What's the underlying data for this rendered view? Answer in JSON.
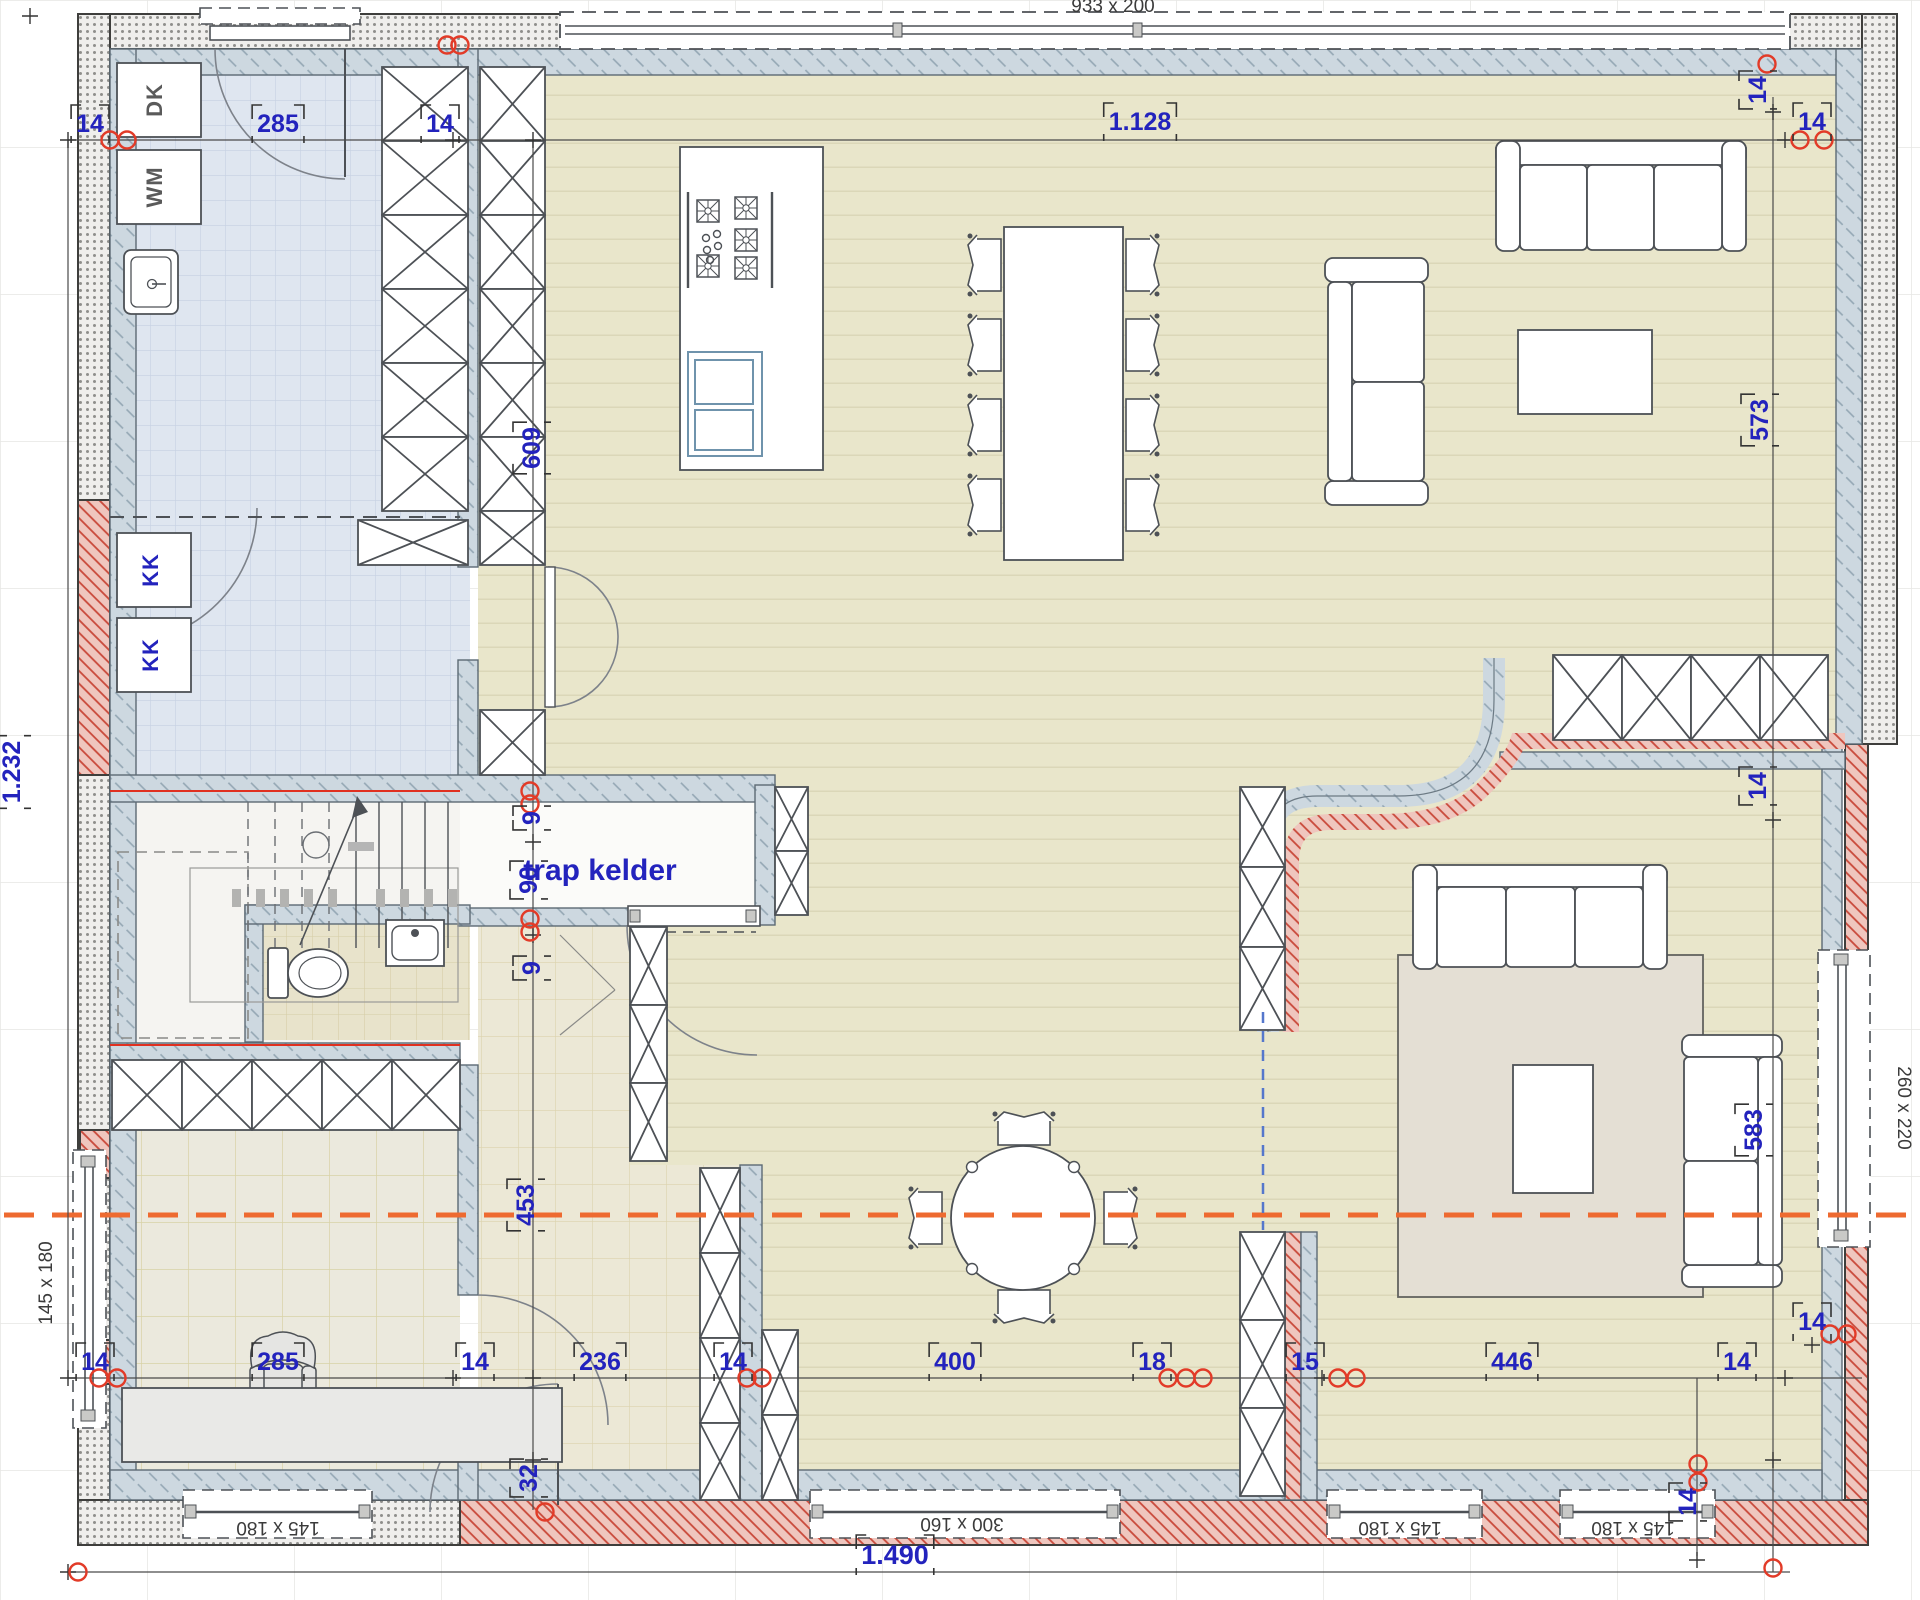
{
  "plan": {
    "room_label": "trap kelder",
    "appliances": {
      "dk": "DK",
      "wm": "WM",
      "kk_upper": "KK",
      "kk_lower": "KK"
    },
    "window_sizes": {
      "top": "933 x 200",
      "left": "145 x 180",
      "right": "260 x 220",
      "bottom_left": "145 x 180",
      "bottom_center": "300 x 160",
      "bottom_mid_right": "145 x 180",
      "bottom_far_right": "145 x 180"
    },
    "dims": {
      "top_14_left": "14",
      "top_285": "285",
      "top_14_mid": "14",
      "top_1128": "1.128",
      "top_14_right": "14",
      "left_1232": "1.232",
      "mid_609": "609",
      "mid_9_upper": "9",
      "mid_90": "90",
      "mid_9_lower": "9",
      "mid_453": "453",
      "mid_32": "32",
      "right_14_top": "14",
      "right_573": "573",
      "right_14_wall": "14",
      "right_583": "583",
      "right_14_lower": "14",
      "right_14_corner": "14",
      "bottom_14_a": "14",
      "bottom_285": "285",
      "bottom_14_b": "14",
      "bottom_236": "236",
      "bottom_14_c": "14",
      "bottom_400": "400",
      "bottom_18": "18",
      "bottom_15": "15",
      "bottom_446": "446",
      "bottom_14_d": "14",
      "total_1490": "1.490"
    },
    "colors": {
      "dim_blue": "#2323bd",
      "marker_red": "#e23b28",
      "axis_orange": "#ee6a30",
      "wall_red_hatch": "#efc6be",
      "wall_blue_hatch": "#cdd8e0",
      "floor_wood": "#e9e6cb",
      "floor_laundry": "#dfe6f0"
    }
  }
}
